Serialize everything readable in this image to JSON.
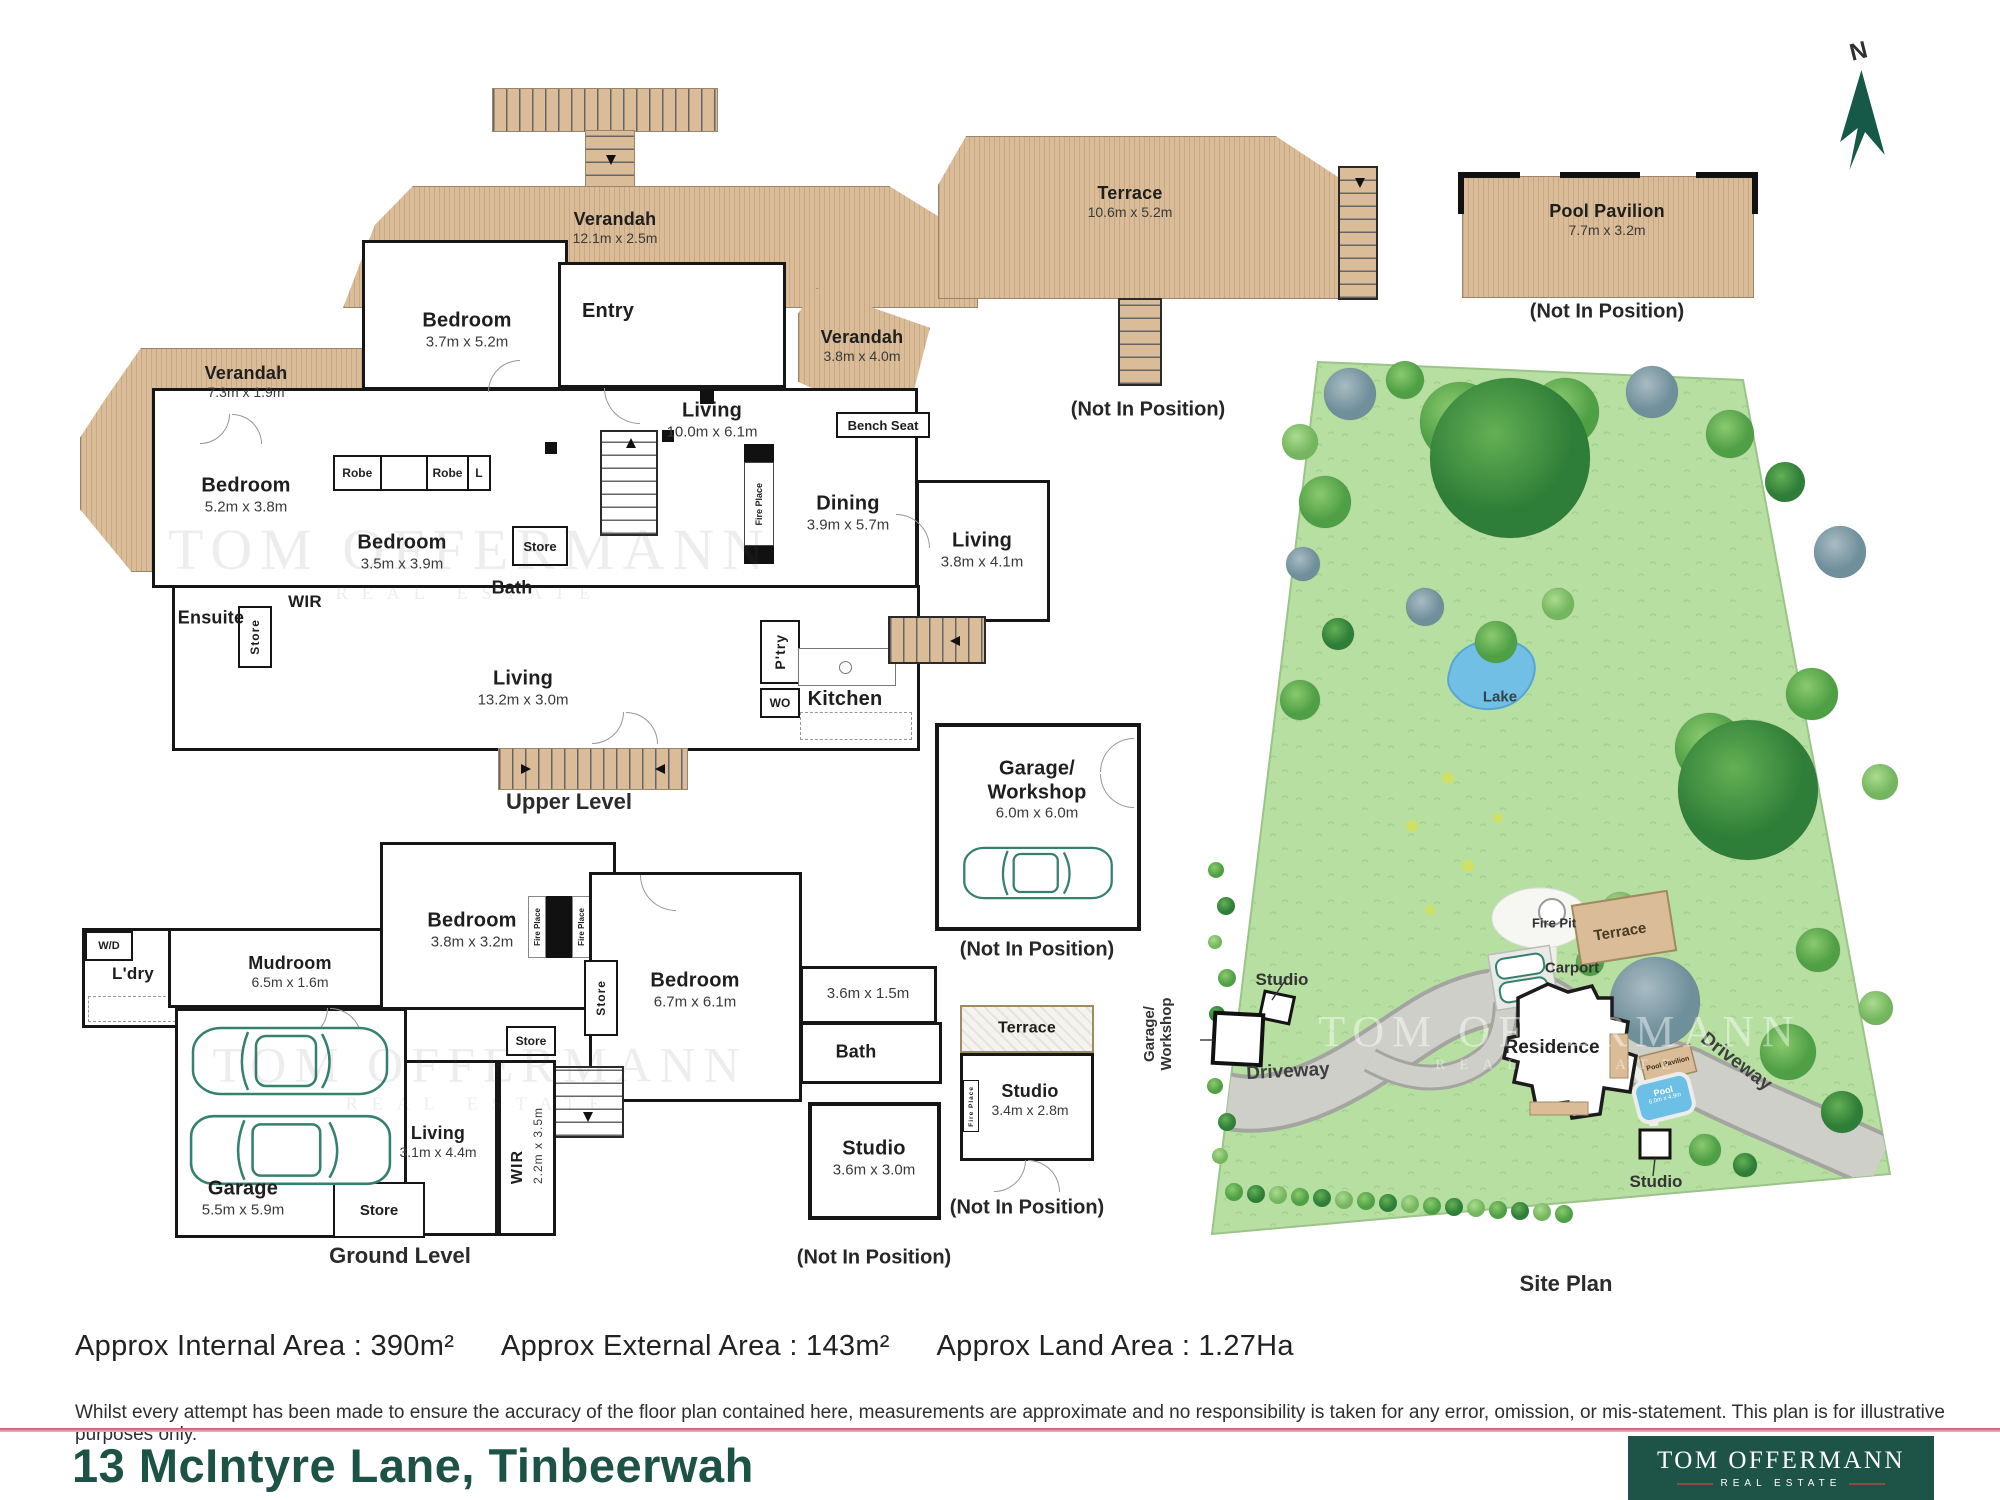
{
  "compass": {
    "label": "N"
  },
  "watermark": {
    "line1": "TOM OFFERMANN",
    "line2": "REAL ESTATE"
  },
  "upper_level": {
    "level_label": "Upper Level",
    "verandah_top": {
      "name": "Verandah",
      "dims": "12.1m x 2.5m"
    },
    "verandah_left": {
      "name": "Verandah",
      "dims": "7.3m x 1.9m"
    },
    "verandah_right": {
      "name": "Verandah",
      "dims": "3.8m x 4.0m"
    },
    "bedroom_top": {
      "name": "Bedroom",
      "dims": "3.7m x 5.2m"
    },
    "entry": {
      "name": "Entry"
    },
    "living_main": {
      "name": "Living",
      "dims": "10.0m x 6.1m"
    },
    "bedroom_left": {
      "name": "Bedroom",
      "dims": "5.2m x 3.8m"
    },
    "bedroom_mid": {
      "name": "Bedroom",
      "dims": "3.5m x 3.9m"
    },
    "robe1": "Robe",
    "robe2": "Robe",
    "linen": "L",
    "store_bath": "Store",
    "bath": {
      "name": "Bath"
    },
    "ensuite": {
      "name": "Ensuite"
    },
    "wir": "WIR",
    "store_left": "Store",
    "living_long": {
      "name": "Living",
      "dims": "13.2m x 3.0m"
    },
    "fireplace": "Fire Place",
    "bench_seat": "Bench Seat",
    "dining": {
      "name": "Dining",
      "dims": "3.9m x 5.7m"
    },
    "living_right": {
      "name": "Living",
      "dims": "3.8m x 4.1m"
    },
    "pantry": "P'try",
    "wall_oven": "WO",
    "kitchen": {
      "name": "Kitchen"
    }
  },
  "terrace_block": {
    "name": "Terrace",
    "dims": "10.6m x 5.2m",
    "note": "(Not In Position)"
  },
  "pool_pavilion_block": {
    "name": "Pool Pavilion",
    "dims": "7.7m x 3.2m",
    "note": "(Not In Position)"
  },
  "ground_level": {
    "level_label": "Ground Level",
    "wd": "W/D",
    "laundry": "L'dry",
    "mudroom": {
      "name": "Mudroom",
      "dims": "6.5m x 1.6m"
    },
    "bedroom_small": {
      "name": "Bedroom",
      "dims": "3.8m x 3.2m"
    },
    "fireplace_left": "Fire Place",
    "fireplace_right": "Fire Place",
    "bedroom_large": {
      "name": "Bedroom",
      "dims": "6.7m x 6.1m"
    },
    "room_dims": "3.6m x 1.5m",
    "bath": {
      "name": "Bath"
    },
    "store_tall": "Store",
    "store_mid": "Store",
    "living": {
      "name": "Living",
      "dims": "3.1m x 4.4m"
    },
    "wir": {
      "name": "WIR",
      "dims": "2.2m x 3.5m"
    },
    "garage": {
      "name": "Garage",
      "dims": "5.5m x 5.9m"
    },
    "store_garage": "Store"
  },
  "garage_workshop_block": {
    "name_line1": "Garage/",
    "name_line2": "Workshop",
    "dims": "6.0m x 6.0m",
    "note": "(Not In Position)"
  },
  "studio_block": {
    "name": "Studio",
    "dims": "3.6m x 3.0m",
    "note": "(Not In Position)"
  },
  "studio_terrace_block": {
    "terrace": "Terrace",
    "name": "Studio",
    "dims": "3.4m x 2.8m",
    "fireplace": "Fire Place",
    "note": "(Not In Position)"
  },
  "site_plan": {
    "title": "Site Plan",
    "lake": "Lake",
    "fire_pit": "Fire Pit",
    "terrace": "Terrace",
    "carport": "Carport",
    "residence": "Residence",
    "pool_pavilion": "Pool Pavilion",
    "pool": {
      "name": "Pool",
      "dims": "6.0m x 4.9m"
    },
    "driveway_left": "Driveway",
    "driveway_right": "Driveway",
    "studio_left": "Studio",
    "studio_bottom": "Studio",
    "garage_workshop_line1": "Garage/",
    "garage_workshop_line2": "Workshop"
  },
  "footer": {
    "internal_area": "Approx Internal Area : 390m²",
    "external_area": "Approx External Area : 143m²",
    "land_area": "Approx Land Area : 1.27Ha",
    "disclaimer": "Whilst every attempt has been made to ensure the accuracy of the floor plan contained here, measurements are approximate and no responsibility is taken for any error, omission, or mis-statement. This plan is for illustrative purposes only.",
    "address": "13 McIntyre Lane, Tinbeerwah",
    "logo_name": "TOM OFFERMANN",
    "logo_tagline": "REAL ESTATE"
  }
}
